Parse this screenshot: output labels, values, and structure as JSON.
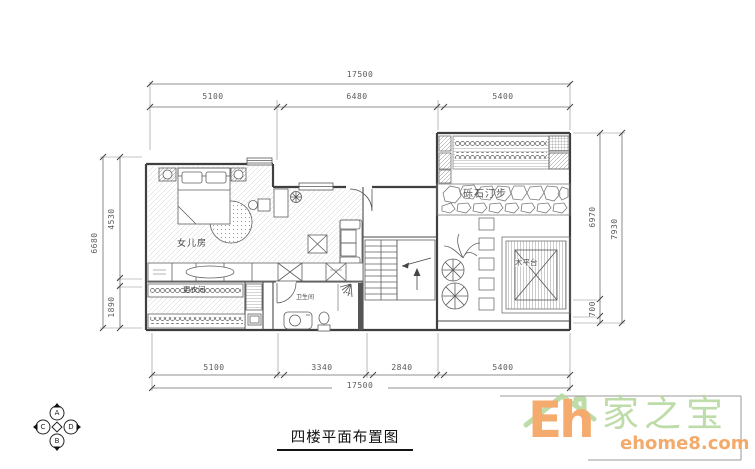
{
  "title": {
    "text": "四楼平面布置图"
  },
  "dimensions": {
    "top": {
      "total": "17500",
      "segments": [
        "5100",
        "6480",
        "5400"
      ]
    },
    "bottom": {
      "total": "17500",
      "segments": [
        "5100",
        "3340",
        "2840",
        "5400"
      ]
    },
    "left": {
      "total": "6680",
      "segments": [
        "4530",
        "1890"
      ]
    },
    "right": {
      "total": "7930",
      "segments": [
        "6970",
        "700"
      ]
    }
  },
  "rooms": {
    "daughter_room": "女儿房",
    "dressing_room": "更衣间",
    "bathroom": "卫生间",
    "gravel_path": "砾石汀步",
    "wood_deck": "木平台"
  },
  "compass": {
    "letters": [
      "A",
      "B",
      "C",
      "D"
    ]
  },
  "watermark": {
    "brand_en_prefix": "Eh",
    "brand_cn": "家之宝",
    "site": "ehome8.com"
  },
  "colors": {
    "wall_line": "#3f3f3f",
    "dim_text": "#5a5a5a",
    "watermark_green": "#b7d9a0",
    "watermark_orange": "#f4a35e"
  }
}
